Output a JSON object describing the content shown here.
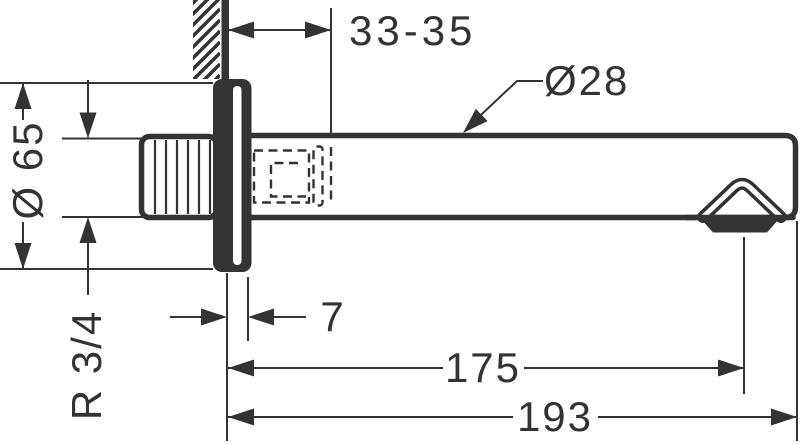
{
  "drawing": {
    "background_color": "#ffffff",
    "line_color": "#333333",
    "dimensions": {
      "wall_offset_range": "33-35",
      "spout_diameter": "Ø28",
      "escutcheon_diameter": "Ø 65",
      "thread_size": "R 3/4",
      "escutcheon_depth": "7",
      "aerator_projection": "175",
      "total_projection": "193"
    }
  }
}
